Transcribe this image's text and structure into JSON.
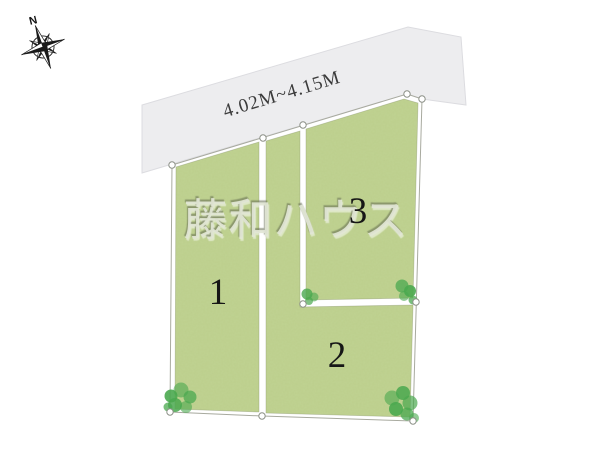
{
  "compass": {
    "north_label": "N"
  },
  "road": {
    "width_label": "4.02M~4.15M"
  },
  "watermark": {
    "text": "藤和ハウス"
  },
  "plots": {
    "plot1": {
      "number": "1"
    },
    "plot2": {
      "number": "2"
    },
    "plot3": {
      "number": "3"
    }
  },
  "colors": {
    "plot_green": "#c0d392",
    "road_gray": "#ededef",
    "bush_green": "#4aa84f",
    "outline_gray": "#a8aa9f"
  }
}
